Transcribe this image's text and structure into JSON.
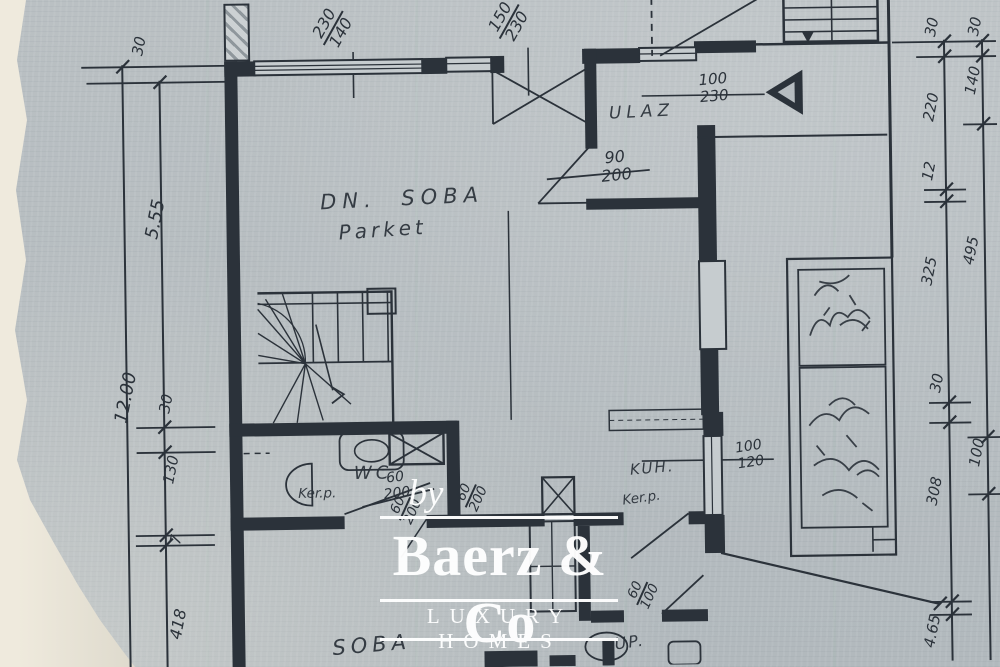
{
  "colors": {
    "ink": "#2b323a",
    "paper": "#b6bcc0",
    "torn_paper": "#efeadd",
    "watermark": "#ffffff"
  },
  "watermark": {
    "prefix": "by",
    "brand": "Baerz & Co",
    "tagline": "LUXURY HOMES"
  },
  "rooms": {
    "dn_soba": {
      "name": "DN. SOBA",
      "finish": "Parket"
    },
    "ulaz": {
      "name": "ULAZ"
    },
    "wc": {
      "name": "WC",
      "finish": "Ker.p."
    },
    "kuh": {
      "name": "KUH.",
      "finish": "Ker.p."
    },
    "soba": {
      "name": "SOBA"
    },
    "kup": {
      "name": "KUP."
    }
  },
  "openings": {
    "win_main": {
      "num": "230",
      "den": "140"
    },
    "door_double": {
      "num": "150",
      "den": "230"
    },
    "door_entry": {
      "num": "100",
      "den": "230"
    },
    "door_ulaz": {
      "num": "90",
      "den": "200"
    },
    "door_wc": {
      "num": "60",
      "den": "200"
    },
    "door_hall_a": {
      "num": "60",
      "den": "200"
    },
    "door_hall_b": {
      "num": "60",
      "den": "200"
    },
    "win_kuh": {
      "num": "100",
      "den": "120"
    },
    "door_kup": {
      "num": "60",
      "den": "100"
    }
  },
  "dims": {
    "left": {
      "w30_top": "30",
      "d555": "5.55",
      "d1200": "12.00",
      "w30_mid": "30",
      "d130": "130",
      "d7": "7",
      "d418": "418"
    },
    "right_inner": [
      "30",
      "220",
      "12",
      "325",
      "30",
      "308",
      "4.65"
    ],
    "right_outer": [
      "30",
      "140",
      "495",
      "100"
    ]
  }
}
